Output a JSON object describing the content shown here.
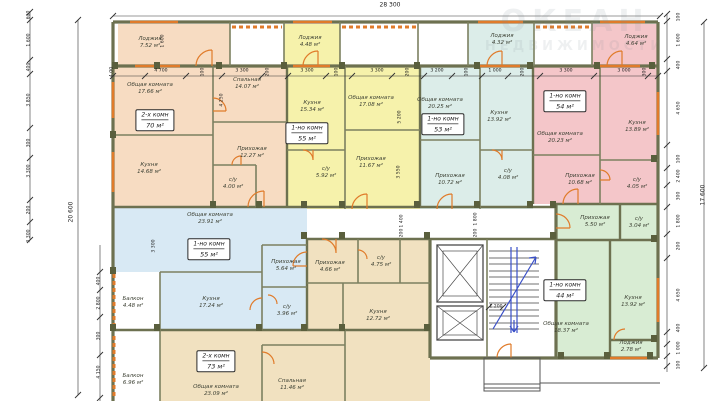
{
  "watermark": {
    "line1": "ОКЕАН",
    "line2": "НЕДВИЖИМОСТИ"
  },
  "dims": {
    "top_total": "28 300",
    "left_total": "20 600",
    "right_total": "17 600",
    "stair": "1 200",
    "top_chain": [
      "4.00",
      "4 700",
      "100",
      "3 300",
      "200",
      "3 300",
      "100",
      "3 300",
      "200",
      "3 200",
      "100",
      "1 000",
      "200",
      "3 300",
      "3 000",
      "300"
    ],
    "left_chain": [
      "600",
      "1 600",
      "400",
      "3 850",
      "300",
      "3 300",
      "200",
      "3 300"
    ],
    "left_inner": [
      "400",
      "2 800",
      "300",
      "4 150"
    ],
    "right_chain": [
      "100",
      "1 600",
      "400",
      "4 650",
      "100",
      "2 400",
      "300",
      "1 800",
      "200",
      "4 650",
      "400",
      "1 000",
      "100"
    ],
    "inner": [
      "1 600",
      "4 250",
      "5 200",
      "3 550",
      "1 400",
      "200",
      "1 800",
      "200",
      "3 300"
    ]
  },
  "apartments": [
    {
      "type_label": "2-х комн",
      "area_label": "70 м²",
      "rooms": [
        {
          "name": "Лоджия",
          "area": "7.52 м²"
        },
        {
          "name": "Общая комната",
          "area": "17.66 м²"
        },
        {
          "name": "Спальная",
          "area": "14.07 м²"
        },
        {
          "name": "Кухня",
          "area": "14.68 м²"
        },
        {
          "name": "Прихожая",
          "area": "12.27 м²"
        },
        {
          "name": "с/у",
          "area": "4.00 м²"
        }
      ]
    },
    {
      "type_label": "1-но комн",
      "area_label": "55 м²",
      "rooms": [
        {
          "name": "Лоджия",
          "area": "4.48 м²"
        },
        {
          "name": "Кухня",
          "area": "15.34 м²"
        },
        {
          "name": "Общая комната",
          "area": "17.08 м²"
        },
        {
          "name": "Прихожая",
          "area": "11.67 м²"
        },
        {
          "name": "с/у",
          "area": "5.92 м²"
        }
      ]
    },
    {
      "type_label": "1-но комн",
      "area_label": "53 м²",
      "rooms": [
        {
          "name": "Лоджия",
          "area": "4.32 м²"
        },
        {
          "name": "Общая комната",
          "area": "20.25 м²"
        },
        {
          "name": "Кухня",
          "area": "13.92 м²"
        },
        {
          "name": "Прихожая",
          "area": "10.72 м²"
        },
        {
          "name": "с/у",
          "area": "4.08 м²"
        }
      ]
    },
    {
      "type_label": "1-но комн",
      "area_label": "54 м²",
      "rooms": [
        {
          "name": "Лоджия",
          "area": "4.64 м²"
        },
        {
          "name": "Общая комната",
          "area": "20.23 м²"
        },
        {
          "name": "Кухня",
          "area": "13.89 м²"
        },
        {
          "name": "Прихожая",
          "area": "10.68 м²"
        },
        {
          "name": "с/у",
          "area": "4.05 м²"
        }
      ]
    },
    {
      "type_label": "1-но комн",
      "area_label": "55 м²",
      "rooms": [
        {
          "name": "Общая комната",
          "area": "23.91 м²"
        },
        {
          "name": "Прихожая",
          "area": "5.64 м²"
        },
        {
          "name": "Кухня",
          "area": "17.24 м²"
        },
        {
          "name": "с/у",
          "area": "3.96 м²"
        },
        {
          "name": "Балкон",
          "area": "4.48 м²"
        }
      ]
    },
    {
      "type_label": "2-х комн",
      "area_label": "73 м²",
      "rooms": [
        {
          "name": "Прихожая",
          "area": "4.66 м²"
        },
        {
          "name": "с/у",
          "area": "4.75 м²"
        },
        {
          "name": "Кухня",
          "area": "12.72 м²"
        },
        {
          "name": "Общая комната",
          "area": "23.09 м²"
        },
        {
          "name": "Спальная",
          "area": "11.46 м²"
        },
        {
          "name": "Балкон",
          "area": "6.96 м²"
        }
      ]
    },
    {
      "type_label": "1-но комн",
      "area_label": "44 м²",
      "rooms": [
        {
          "name": "Прихожая",
          "area": "5.50 м²"
        },
        {
          "name": "с/у",
          "area": "3.04 м²"
        },
        {
          "name": "Общая комната",
          "area": "18.37 м²"
        },
        {
          "name": "Кухня",
          "area": "13.92 м²"
        },
        {
          "name": "Лоджия",
          "area": "2.78 м²"
        }
      ]
    }
  ],
  "colors": {
    "apt1": "#f7dcc2",
    "apt2": "#f6f2ab",
    "apt3": "#dcede9",
    "apt4": "#f4c6c9",
    "apt5": "#d8e9f4",
    "apt6": "#f1e1c0",
    "apt7": "#d8ecd3",
    "wall": "#6d7150",
    "accent": "#e07b2a",
    "stairs": "#3a50c8"
  }
}
